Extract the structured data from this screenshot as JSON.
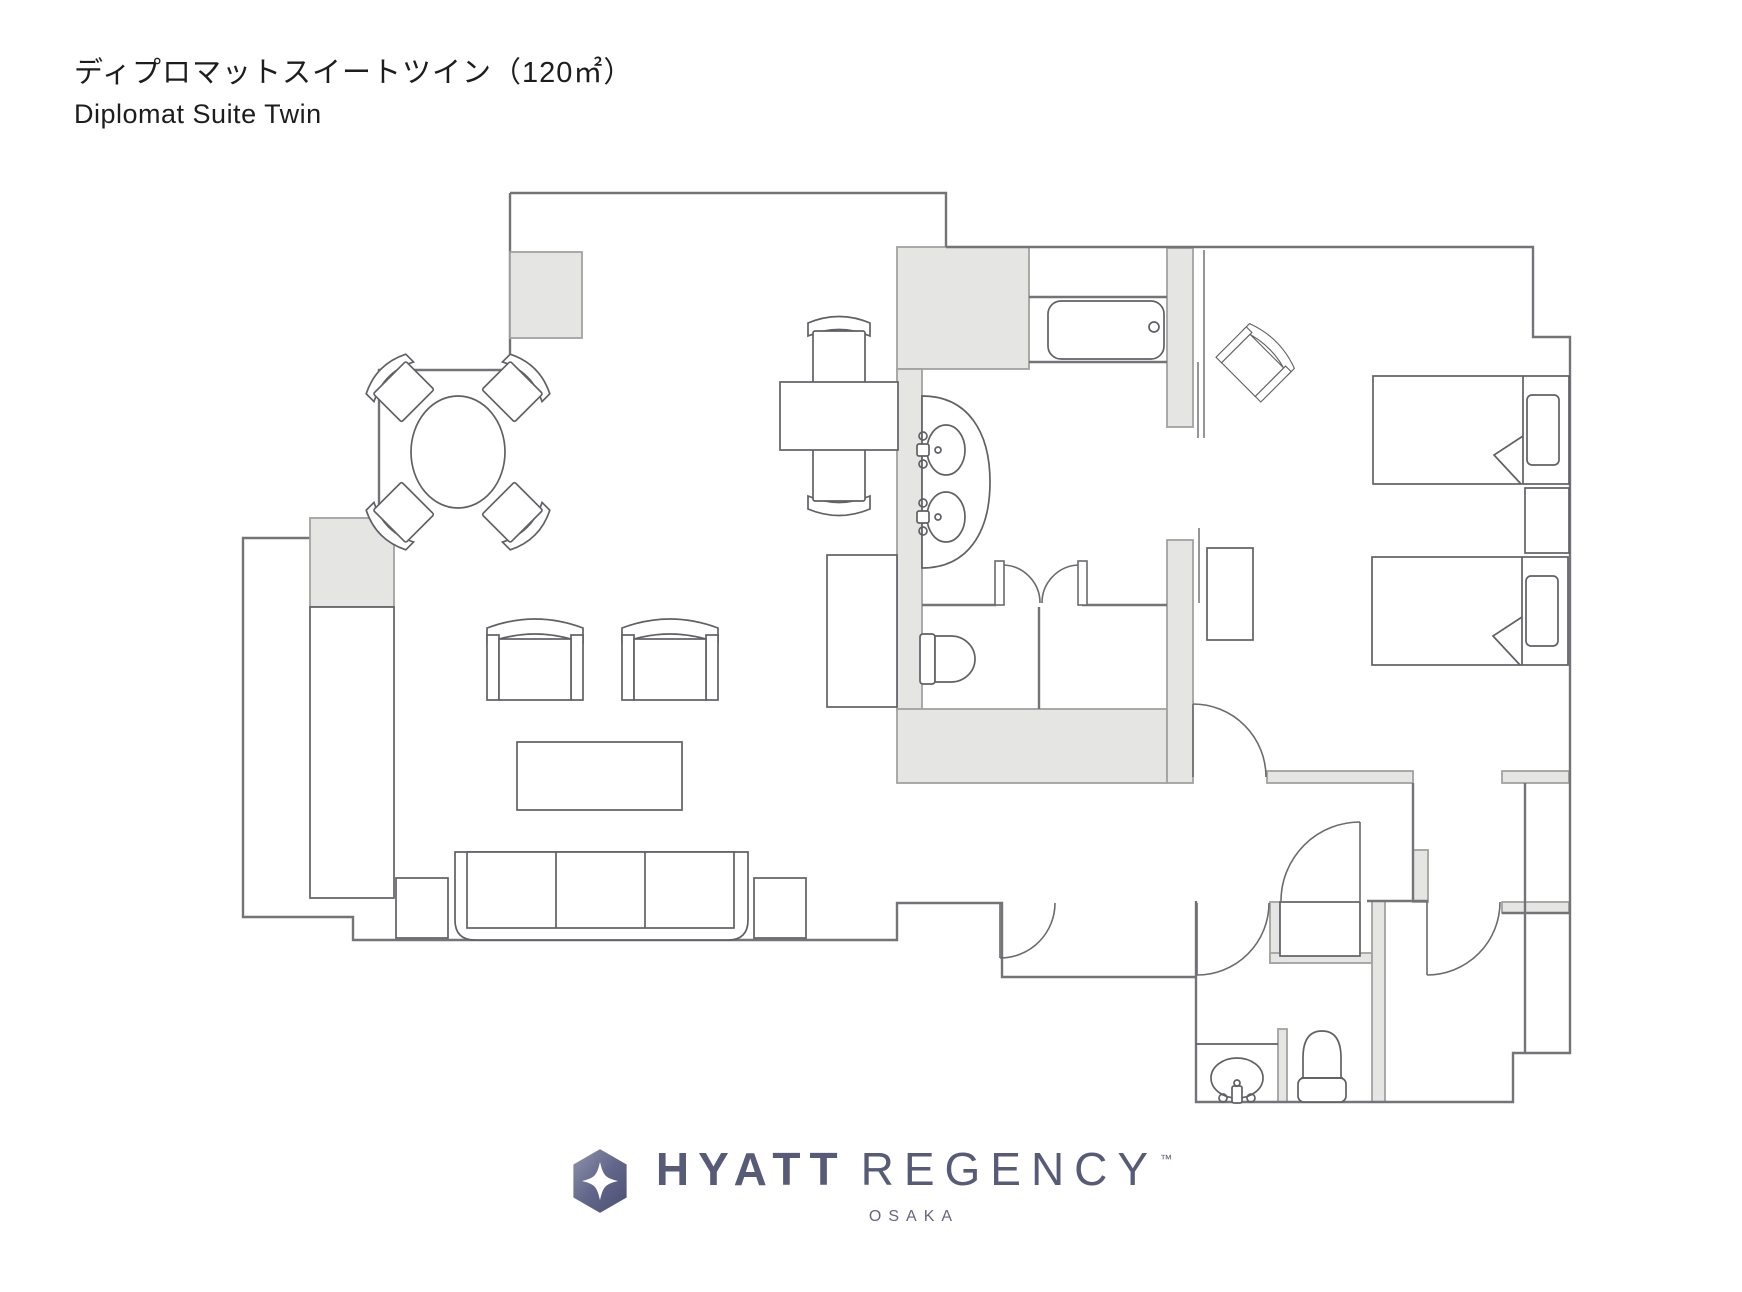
{
  "header": {
    "title_jp": "ディプロマットスイートツイン（120㎡）",
    "title_en": "Diplomat Suite Twin"
  },
  "logo": {
    "brand_word1": "HYATT",
    "brand_word2": "REGENCY",
    "trademark": "™",
    "location": "OSAKA",
    "brand_color": "#575b78"
  },
  "palette": {
    "background": "#ffffff",
    "wall_line": "#737478",
    "wall_fill": "#e5e5e3",
    "furniture_line": "#606165"
  }
}
